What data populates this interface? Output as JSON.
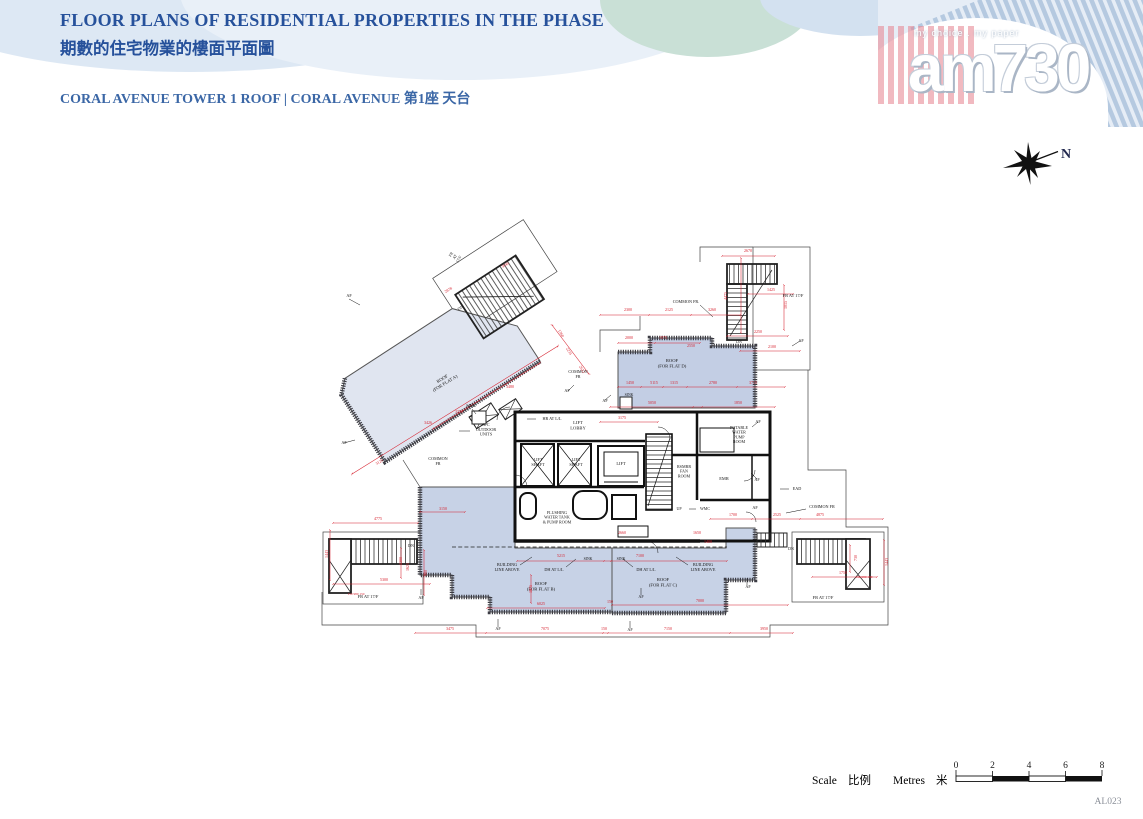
{
  "page": {
    "code": "AL023"
  },
  "header": {
    "title_en": "FLOOR PLANS OF RESIDENTIAL PROPERTIES IN THE PHASE",
    "title_zh": "期數的住宅物業的樓面平面圖",
    "subtitle": "CORAL AVENUE TOWER 1  ROOF |  CORAL AVENUE 第1座 天台",
    "logo": {
      "tagline": "my choice . my paper",
      "name": "am730"
    }
  },
  "compass": {
    "label": "N"
  },
  "scale_bar": {
    "scale_en": "Scale",
    "scale_zh": "比例",
    "metres_en": "Metres",
    "metres_zh": "米",
    "ticks": [
      "0",
      "2",
      "4",
      "6",
      "8"
    ]
  },
  "colors": {
    "title_blue": "#26519b",
    "subtitle_blue": "#3b67a6",
    "roof_fill": "#c7d2e6",
    "roof_fill_light": "#e0e5f0",
    "dim_red": "#d61f2c",
    "wall_black": "#111111"
  },
  "plan": {
    "room_labels": [
      {
        "t": "ROOF\n(FOR FLAT A)",
        "x": 443,
        "y": 380,
        "r": -32,
        "s": 4.6
      },
      {
        "t": "ROOF\n(FOR FLAT D)",
        "x": 672,
        "y": 362,
        "s": 4.6
      },
      {
        "t": "ROOF\n(FOR FLAT B)",
        "x": 541,
        "y": 585,
        "s": 4.6
      },
      {
        "t": "ROOF\n(FOR FLAT C)",
        "x": 663,
        "y": 581,
        "s": 4.6
      },
      {
        "t": "LIFT\nLOBBY",
        "x": 578,
        "y": 424,
        "s": 4.6
      },
      {
        "t": "LIFT\nSHAFT",
        "x": 538,
        "y": 461,
        "s": 4.2
      },
      {
        "t": "LIFT\nSHAFT",
        "x": 576,
        "y": 461,
        "s": 4.2
      },
      {
        "t": "LIFT",
        "x": 621,
        "y": 465,
        "s": 4.4
      },
      {
        "t": "RSMRR\nFAN\nROOM",
        "x": 684,
        "y": 468,
        "s": 4.1
      },
      {
        "t": "EMR",
        "x": 724,
        "y": 480,
        "s": 4.4
      },
      {
        "t": "POTABLE\nWATER\nPUMP\nROOM",
        "x": 739,
        "y": 429,
        "s": 4.1
      },
      {
        "t": "FLUSHING\nWATER TANK\n& PUMP ROOM",
        "x": 557,
        "y": 514,
        "s": 4.1
      },
      {
        "t": "FR AT 17/F",
        "x": 793,
        "y": 297,
        "s": 4.4
      },
      {
        "t": "FR AT 17/F",
        "x": 368,
        "y": 598,
        "s": 4.4
      },
      {
        "t": "FR AT 17/F",
        "x": 823,
        "y": 599,
        "s": 4.4
      },
      {
        "t": "FR\nAT\n17/F",
        "x": 452,
        "y": 255,
        "r": -58,
        "s": 4
      },
      {
        "t": "COMMON FR.",
        "x": 686,
        "y": 303,
        "s": 4.2
      },
      {
        "t": "COMMON\nFR",
        "x": 578,
        "y": 373,
        "s": 4.2
      },
      {
        "t": "COMMON\nFR",
        "x": 438,
        "y": 460,
        "s": 4.2
      },
      {
        "t": "COMMON FR",
        "x": 822,
        "y": 508,
        "s": 4.2
      },
      {
        "t": "HR AT L/L",
        "x": 552,
        "y": 420,
        "s": 4.2
      },
      {
        "t": "BUILDING\nLINE ABOVE",
        "x": 507,
        "y": 566,
        "s": 4.2
      },
      {
        "t": "DH AT L/L",
        "x": 554,
        "y": 571,
        "s": 4.2
      },
      {
        "t": "DH AT L/L",
        "x": 646,
        "y": 571,
        "s": 4.2
      },
      {
        "t": "BUILDING\nLINE ABOVE",
        "x": 703,
        "y": 566,
        "s": 4.2
      },
      {
        "t": "A/C\nOUTDOOR\nUNITS",
        "x": 486,
        "y": 426,
        "s": 4.2
      },
      {
        "t": "SINK",
        "x": 471,
        "y": 407,
        "s": 4.2
      },
      {
        "t": "SINK",
        "x": 588,
        "y": 560,
        "s": 3.8
      },
      {
        "t": "SINK",
        "x": 621,
        "y": 560,
        "s": 3.8
      },
      {
        "t": "SINK",
        "x": 629,
        "y": 396,
        "s": 3.8
      },
      {
        "t": "DN",
        "x": 411,
        "y": 547,
        "s": 4
      },
      {
        "t": "DN",
        "x": 791,
        "y": 550,
        "s": 4
      },
      {
        "t": "DN",
        "x": 739,
        "y": 343,
        "s": 4
      },
      {
        "t": "DN",
        "x": 461,
        "y": 309,
        "r": -32,
        "s": 4
      },
      {
        "t": "UP",
        "x": 679,
        "y": 510,
        "s": 4
      },
      {
        "t": "WMC",
        "x": 705,
        "y": 510,
        "s": 4
      },
      {
        "t": "EAD",
        "x": 797,
        "y": 490,
        "s": 4.2
      },
      {
        "t": "AF",
        "x": 349,
        "y": 297,
        "s": 4.2
      },
      {
        "t": "AF",
        "x": 344,
        "y": 444,
        "s": 4.2
      },
      {
        "t": "AF",
        "x": 567,
        "y": 392,
        "s": 4.2
      },
      {
        "t": "AF",
        "x": 605,
        "y": 402,
        "s": 4.2
      },
      {
        "t": "AF",
        "x": 758,
        "y": 423,
        "s": 4.2
      },
      {
        "t": "AF",
        "x": 757,
        "y": 481,
        "s": 4.2
      },
      {
        "t": "AF",
        "x": 755,
        "y": 509,
        "s": 4.2
      },
      {
        "t": "AF",
        "x": 801,
        "y": 342,
        "s": 4.2
      },
      {
        "t": "AF",
        "x": 641,
        "y": 598,
        "s": 4.2
      },
      {
        "t": "AF",
        "x": 748,
        "y": 588,
        "s": 4.2
      },
      {
        "t": "AF",
        "x": 498,
        "y": 630,
        "s": 4.2
      },
      {
        "t": "AF",
        "x": 630,
        "y": 631,
        "s": 4.2
      },
      {
        "t": "AF",
        "x": 421,
        "y": 599,
        "s": 4.2
      }
    ],
    "dim_labels": [
      {
        "t": "3475",
        "x": 450,
        "y": 630
      },
      {
        "t": "7075",
        "x": 545,
        "y": 630
      },
      {
        "t": "150",
        "x": 604,
        "y": 630
      },
      {
        "t": "7150",
        "x": 668,
        "y": 630
      },
      {
        "t": "3950",
        "x": 764,
        "y": 630
      },
      {
        "t": "6025",
        "x": 541,
        "y": 605
      },
      {
        "t": "150",
        "x": 610,
        "y": 603
      },
      {
        "t": "7000",
        "x": 700,
        "y": 602
      },
      {
        "t": "4775",
        "x": 378,
        "y": 520
      },
      {
        "t": "5300",
        "x": 384,
        "y": 581
      },
      {
        "t": "1443",
        "x": 328,
        "y": 554,
        "r": -90
      },
      {
        "t": "980",
        "x": 427,
        "y": 573,
        "r": -90
      },
      {
        "t": "150 980 150",
        "x": 356,
        "y": 595,
        "s": 3.4
      },
      {
        "t": "1300",
        "x": 402,
        "y": 561,
        "r": -90
      },
      {
        "t": "1625",
        "x": 409,
        "y": 567,
        "r": -90
      },
      {
        "t": "3125",
        "x": 380,
        "y": 463,
        "r": -32
      },
      {
        "t": "3480",
        "x": 510,
        "y": 388
      },
      {
        "t": "3370",
        "x": 459,
        "y": 413
      },
      {
        "t": "3426",
        "x": 428,
        "y": 424
      },
      {
        "t": "3045",
        "x": 506,
        "y": 266,
        "r": -32
      },
      {
        "t": "2878",
        "x": 449,
        "y": 291,
        "r": -32
      },
      {
        "t": "1360",
        "x": 560,
        "y": 334,
        "r": 58
      },
      {
        "t": "2235",
        "x": 568,
        "y": 352,
        "r": 58
      },
      {
        "t": "2612",
        "x": 581,
        "y": 370,
        "r": 58
      },
      {
        "t": "2300",
        "x": 628,
        "y": 311
      },
      {
        "t": "2125",
        "x": 669,
        "y": 311
      },
      {
        "t": "3260",
        "x": 712,
        "y": 311
      },
      {
        "t": "4475",
        "x": 727,
        "y": 296,
        "r": -90
      },
      {
        "t": "2670",
        "x": 748,
        "y": 252
      },
      {
        "t": "1425",
        "x": 771,
        "y": 291
      },
      {
        "t": "2250",
        "x": 758,
        "y": 333
      },
      {
        "t": "2100",
        "x": 772,
        "y": 348
      },
      {
        "t": "1015",
        "x": 787,
        "y": 305,
        "r": -90
      },
      {
        "t": "2000",
        "x": 629,
        "y": 339
      },
      {
        "t": "1975",
        "x": 663,
        "y": 339
      },
      {
        "t": "2550",
        "x": 691,
        "y": 347
      },
      {
        "t": "1450",
        "x": 630,
        "y": 384
      },
      {
        "t": "5115",
        "x": 654,
        "y": 384
      },
      {
        "t": "1315",
        "x": 674,
        "y": 384
      },
      {
        "t": "2780",
        "x": 713,
        "y": 384
      },
      {
        "t": "3715",
        "x": 753,
        "y": 384
      },
      {
        "t": "5050",
        "x": 652,
        "y": 404
      },
      {
        "t": "1850",
        "x": 738,
        "y": 404
      },
      {
        "t": "3175",
        "x": 622,
        "y": 419
      },
      {
        "t": "1700",
        "x": 733,
        "y": 516
      },
      {
        "t": "2525",
        "x": 777,
        "y": 516
      },
      {
        "t": "4875",
        "x": 820,
        "y": 516
      },
      {
        "t": "1750",
        "x": 843,
        "y": 574
      },
      {
        "t": "150 980 150",
        "x": 864,
        "y": 578,
        "s": 3.4
      },
      {
        "t": "1443",
        "x": 888,
        "y": 562,
        "r": -90
      },
      {
        "t": "730",
        "x": 857,
        "y": 558,
        "r": -90
      },
      {
        "t": "2660",
        "x": 622,
        "y": 534
      },
      {
        "t": "1650",
        "x": 697,
        "y": 534
      },
      {
        "t": "1400",
        "x": 708,
        "y": 543
      },
      {
        "t": "5215",
        "x": 561,
        "y": 557
      },
      {
        "t": "7100",
        "x": 640,
        "y": 557
      },
      {
        "t": "3150",
        "x": 443,
        "y": 510
      },
      {
        "t": "1875",
        "x": 532,
        "y": 589,
        "r": -90
      }
    ]
  }
}
